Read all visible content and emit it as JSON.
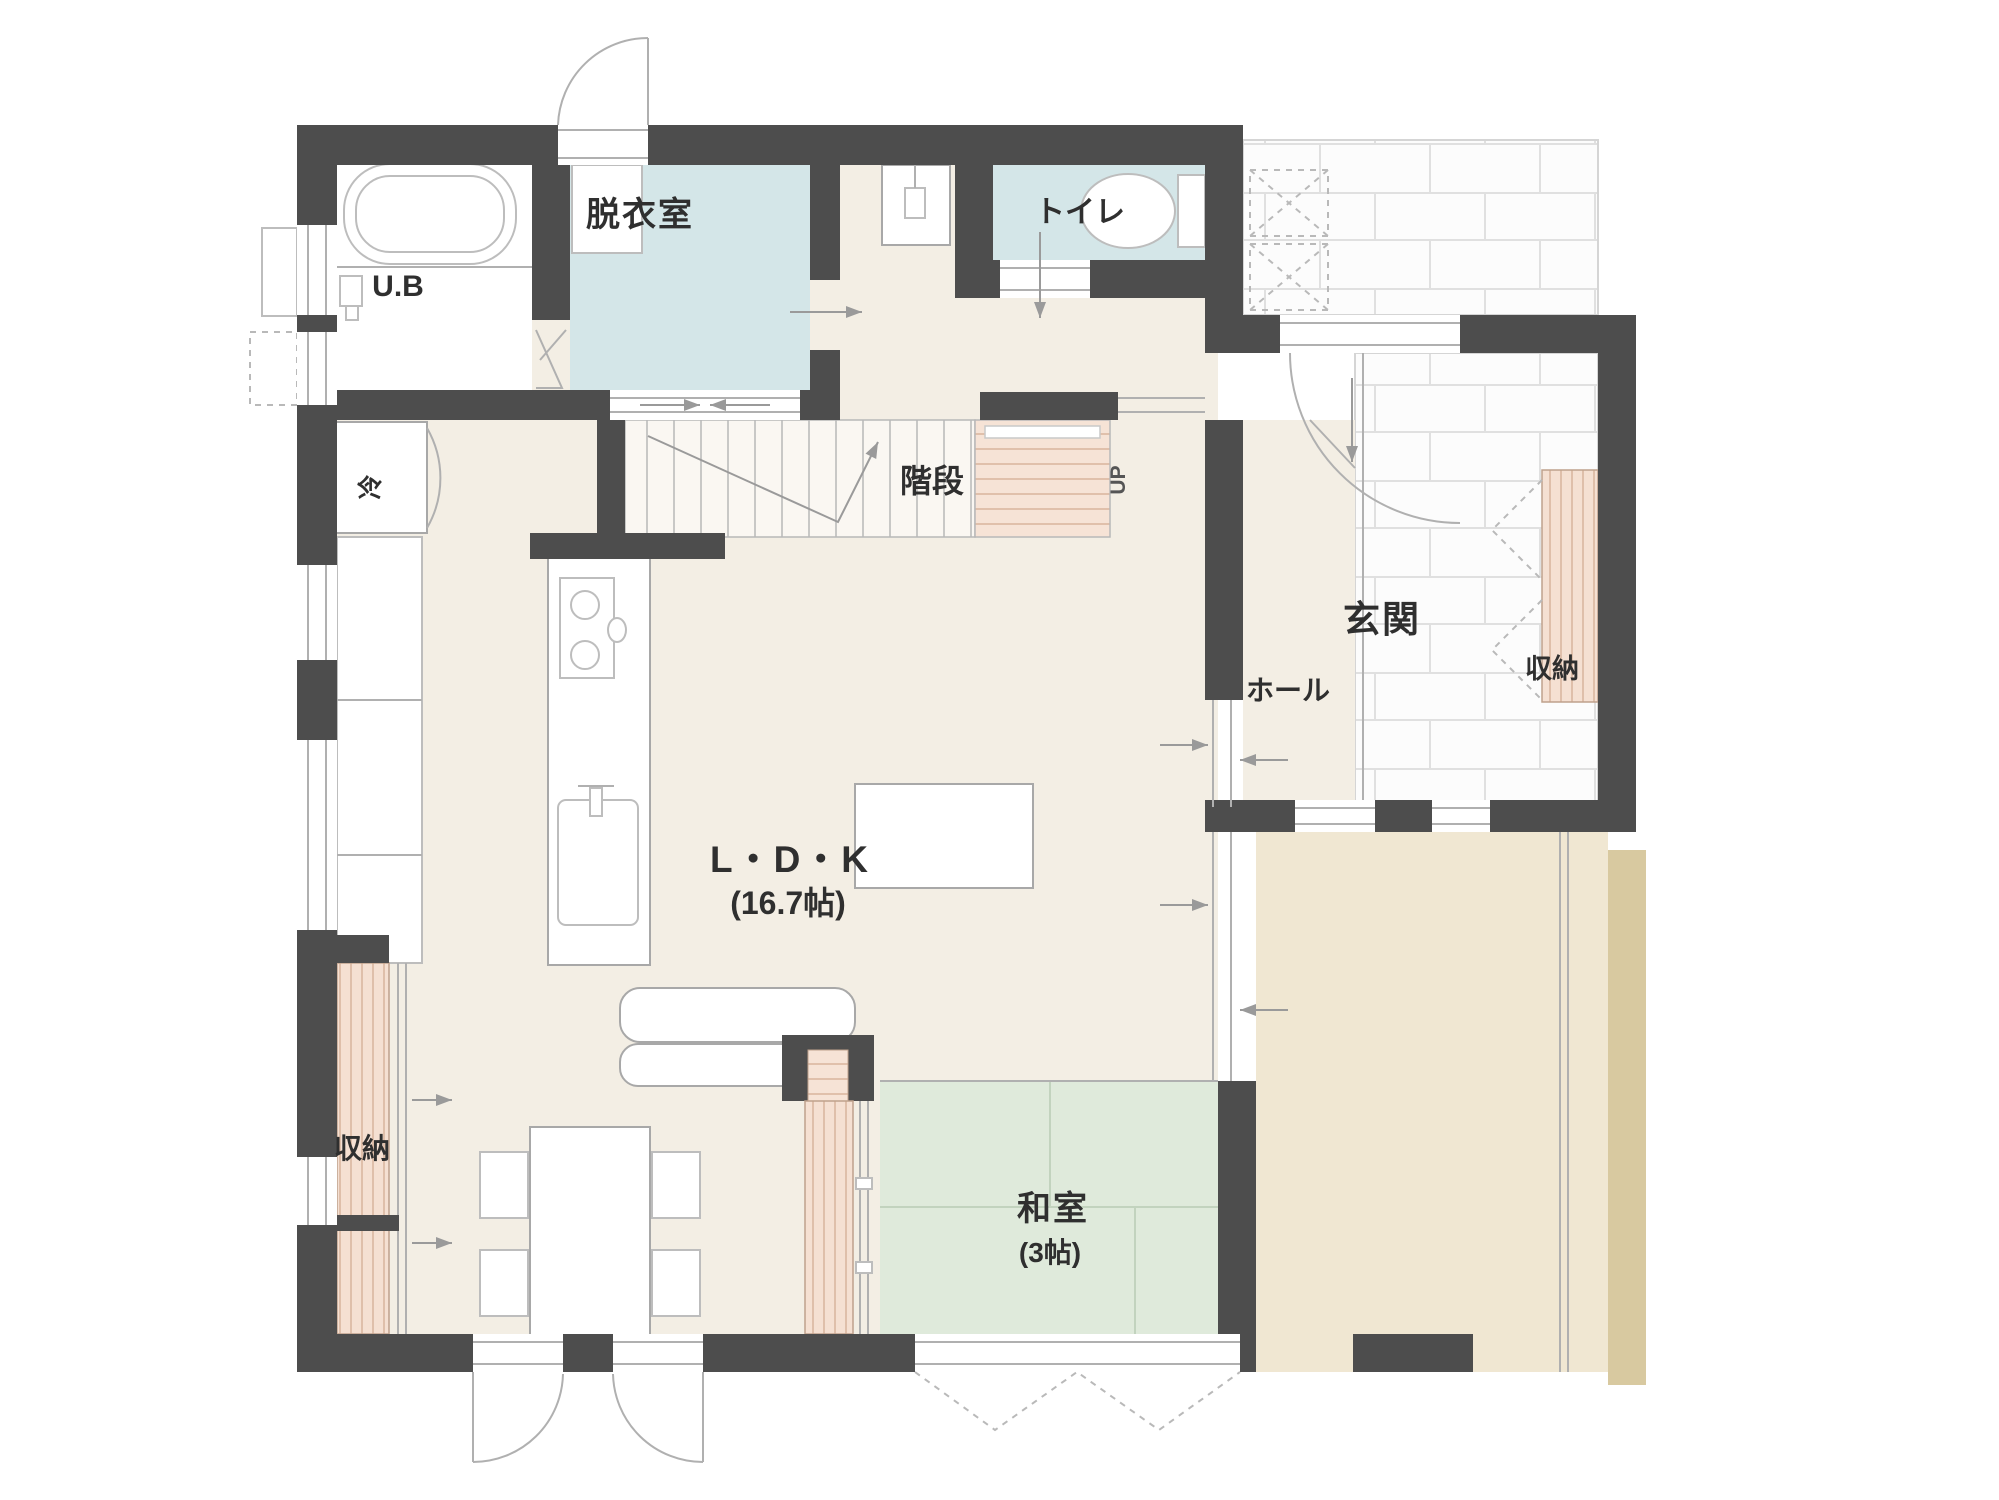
{
  "meta": {
    "type": "japanese-residential-floor-plan"
  },
  "palette": {
    "wall": "#4d4d4d",
    "floor": "#f3eee4",
    "wet_room": "#d4e6e8",
    "tatami": "#dfeadb",
    "tatami_line": "#c2d3be",
    "wood_shelf": "#f5e0d2",
    "wood_line": "#d8b49d",
    "deck": "#f0e7d2",
    "deck_shadow": "#d8c9a0",
    "tile_fill": "#fcfcfc",
    "hall_floor": "#f3eee4",
    "counter": "#ffffff"
  },
  "rooms": {
    "ub": {
      "label": "U.B"
    },
    "dressing": {
      "label": "脱衣室"
    },
    "toilet": {
      "label": "トイレ"
    },
    "stairs": {
      "label": "階段",
      "up": "UP"
    },
    "entrance": {
      "label": "玄関"
    },
    "hall": {
      "label": "ホール"
    },
    "entrance_storage": {
      "label": "収納"
    },
    "ldk": {
      "label": "L・D・K",
      "size": "(16.7帖)"
    },
    "kitchen_storage": {
      "label": "収納"
    },
    "washitsu": {
      "label": "和室",
      "size": "(3帖)"
    },
    "fridge": {
      "label": "冷"
    }
  }
}
